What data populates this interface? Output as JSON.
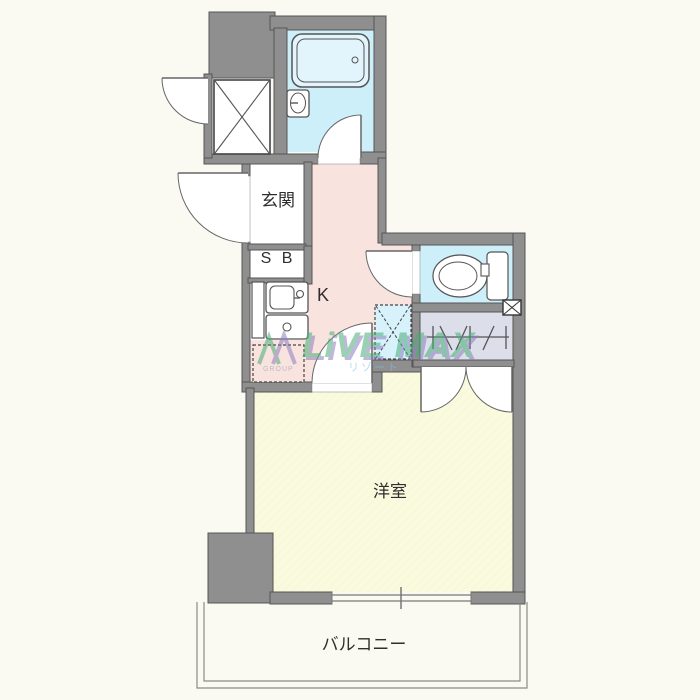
{
  "floorplan": {
    "rooms": {
      "entrance_label": "玄関",
      "shoebox_label": "S B",
      "kitchen_label": "K",
      "western_room_label": "洋室",
      "balcony_label": "バルコニー"
    },
    "watermark": {
      "brand": "LiVE MAX",
      "brand_sub": "リゾート",
      "logo_caption": "GROUP"
    },
    "colors": {
      "wall_gray": "#8f8f8f",
      "water_blue": "#cdeffa",
      "washer_blue": "#d8f2fc",
      "hallway_pink": "#f9e3de",
      "room_yellow": "#fafade",
      "closet_gray": "#dcdfe9",
      "canvas_bg": "#fafaf2",
      "line_dark": "#555555"
    }
  }
}
